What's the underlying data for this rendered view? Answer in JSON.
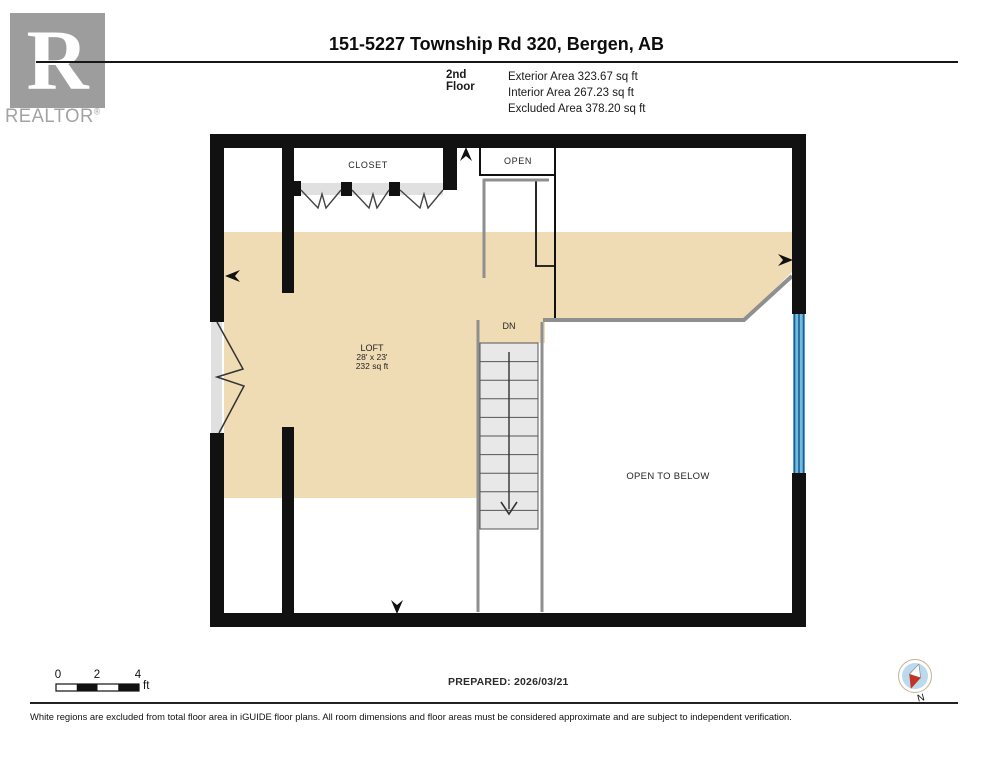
{
  "brand": {
    "logo_letter": "R",
    "logo_text": "REALTOR",
    "registered": "®"
  },
  "header": {
    "title": "151-5227 Township Rd 320, Bergen, AB",
    "floor_label": "2nd Floor",
    "areas": [
      "Exterior Area 323.67 sq ft",
      "Interior Area 267.23 sq ft",
      "Excluded Area 378.20 sq ft"
    ]
  },
  "floor_plan": {
    "rooms": {
      "closet_label": "CLOSET",
      "open_label": "OPEN",
      "loft_name": "LOFT",
      "loft_dimensions": "28' x 23'",
      "loft_area": "232 sq ft",
      "stairs_direction_label": "DN",
      "open_to_below_label": "OPEN TO BELOW"
    },
    "colors": {
      "included_area_fill": "#efdcb5",
      "wall": "#111111",
      "railing": "#8f8f8f",
      "window_glass": "#72bce2",
      "window_frame": "#1b5e93",
      "stair_fill": "#e8e8e8",
      "door_track": "#e0e0e0",
      "compass_needle_red": "#c43425",
      "compass_disc": "#bcdaed"
    }
  },
  "footer": {
    "scale": {
      "tick_labels": [
        "0",
        "2",
        "4"
      ],
      "unit": "ft"
    },
    "prepared_label": "PREPARED: 2026/03/21",
    "compass_label": "N",
    "disclaimer": "White regions are excluded from total floor area in iGUIDE floor plans. All room dimensions and floor areas must be considered approximate and are subject to independent verification."
  }
}
